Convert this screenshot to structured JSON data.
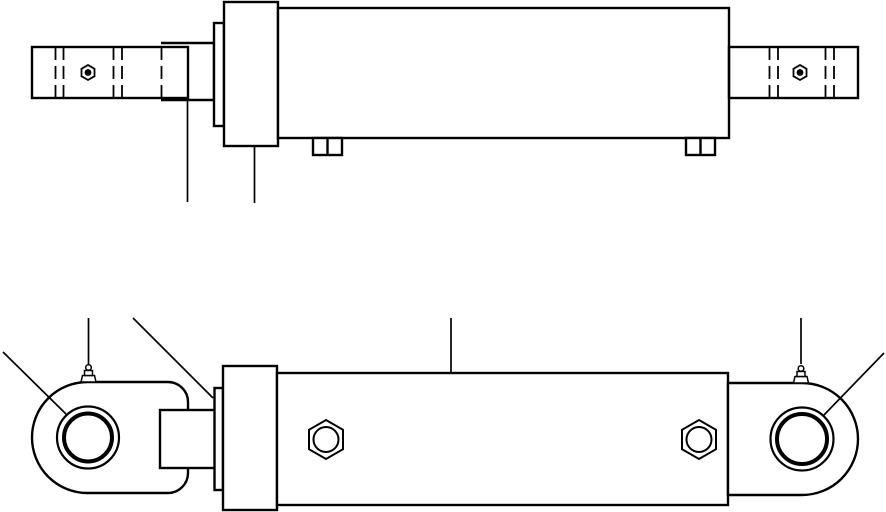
{
  "drawing": {
    "width": 886,
    "height": 512,
    "background": "#ffffff",
    "line_color": "#000000",
    "views": [
      {
        "name": "top-view",
        "shapes": [
          {
            "name": "piston-rod-block",
            "type": "path",
            "d": "M 161 43 L 214 43 L 214 100 L 161 100",
            "fill": "white",
            "sw": 2.4
          },
          {
            "name": "gland-flange",
            "type": "rect",
            "x": 214,
            "y": 23,
            "w": 10,
            "h": 103,
            "fill": "white",
            "sw": 2.4
          },
          {
            "name": "head-cap",
            "type": "rect",
            "x": 224,
            "y": 2,
            "w": 54,
            "h": 144,
            "fill": "white",
            "sw": 2.4
          },
          {
            "name": "cylinder-barrel",
            "type": "rect",
            "x": 278,
            "y": 8,
            "w": 451,
            "h": 130,
            "fill": "white",
            "sw": 2.4
          },
          {
            "name": "port-boss-left",
            "type": "rect",
            "x": 313,
            "y": 138,
            "w": 29,
            "h": 17,
            "fill": "white",
            "sw": 2.4
          },
          {
            "name": "port-boss-left-divider",
            "type": "line",
            "x1": 327.5,
            "y1": 138,
            "x2": 327.5,
            "y2": 155,
            "sw": 2.4
          },
          {
            "name": "port-boss-right",
            "type": "rect",
            "x": 686,
            "y": 138,
            "w": 29,
            "h": 17,
            "fill": "white",
            "sw": 2.4
          },
          {
            "name": "port-boss-right-divider",
            "type": "line",
            "x1": 700.5,
            "y1": 138,
            "x2": 700.5,
            "y2": 155,
            "sw": 2.4
          },
          {
            "name": "rod-eye-plate",
            "type": "rect",
            "x": 32,
            "y": 47,
            "w": 156,
            "h": 51,
            "fill": "none",
            "sw": 2.4
          },
          {
            "name": "rod-eye-groove-line-1",
            "type": "line",
            "x1": 55.5,
            "y1": 47,
            "x2": 55.5,
            "y2": 98,
            "sw": 1.8,
            "dash": "13 6"
          },
          {
            "name": "rod-eye-groove-line-2",
            "type": "line",
            "x1": 63.5,
            "y1": 47,
            "x2": 63.5,
            "y2": 98,
            "sw": 1.8,
            "dash": "13 6"
          },
          {
            "name": "rod-eye-groove-line-3",
            "type": "line",
            "x1": 113.5,
            "y1": 47,
            "x2": 113.5,
            "y2": 98,
            "sw": 1.8,
            "dash": "13 6"
          },
          {
            "name": "rod-eye-groove-line-4",
            "type": "line",
            "x1": 122,
            "y1": 47,
            "x2": 122,
            "y2": 98,
            "sw": 1.8,
            "dash": "13 6"
          },
          {
            "name": "rod-hidden-edge",
            "type": "line",
            "x1": 161.5,
            "y1": 47,
            "x2": 161.5,
            "y2": 98,
            "sw": 1.8,
            "dash": "13 6"
          },
          {
            "name": "rod-eye-pin-nut",
            "type": "polygon",
            "points": "88,65 94.5,68.8 94.5,76.2 88,80 81.5,76.2 81.5,68.8",
            "fill": "none",
            "sw": 1.8
          },
          {
            "name": "rod-eye-pin-nut-center",
            "type": "circle",
            "cx": 88,
            "cy": 72.5,
            "r": 3.4,
            "fill": "black",
            "sw": 0
          },
          {
            "name": "cap-eye-plate",
            "type": "rect",
            "x": 729,
            "y": 47,
            "w": 129,
            "h": 51,
            "fill": "none",
            "sw": 2.4
          },
          {
            "name": "cap-eye-groove-line-1",
            "type": "line",
            "x1": 769.5,
            "y1": 47,
            "x2": 769.5,
            "y2": 98,
            "sw": 1.8,
            "dash": "13 6"
          },
          {
            "name": "cap-eye-groove-line-2",
            "type": "line",
            "x1": 778,
            "y1": 47,
            "x2": 778,
            "y2": 98,
            "sw": 1.8,
            "dash": "13 6"
          },
          {
            "name": "cap-eye-groove-line-3",
            "type": "line",
            "x1": 825.5,
            "y1": 47,
            "x2": 825.5,
            "y2": 98,
            "sw": 1.8,
            "dash": "13 6"
          },
          {
            "name": "cap-eye-groove-line-4",
            "type": "line",
            "x1": 834,
            "y1": 47,
            "x2": 834,
            "y2": 98,
            "sw": 1.8,
            "dash": "13 6"
          },
          {
            "name": "cap-eye-pin-nut",
            "type": "polygon",
            "points": "800,65 806.5,68.8 806.5,76.2 800,80 793.5,76.2 793.5,68.8",
            "fill": "none",
            "sw": 1.8
          },
          {
            "name": "cap-eye-pin-nut-center",
            "type": "circle",
            "cx": 800,
            "cy": 72.5,
            "r": 3.4,
            "fill": "black",
            "sw": 0
          },
          {
            "name": "rod-leader-line",
            "type": "line",
            "x1": 187.5,
            "y1": 100,
            "x2": 187.5,
            "y2": 202,
            "sw": 1.7
          },
          {
            "name": "gland-leader-line",
            "type": "line",
            "x1": 254.5,
            "y1": 146,
            "x2": 254.5,
            "y2": 203,
            "sw": 1.7
          }
        ]
      },
      {
        "name": "side-view",
        "shapes": [
          {
            "name": "rod-eye-housing",
            "type": "roundrect",
            "x": 32,
            "y": 382,
            "w": 156,
            "h": 111,
            "radii": [
              55.5,
              20,
              20,
              55.5
            ],
            "fill": "white",
            "sw": 2.4
          },
          {
            "name": "rod-eye-bushing-outer",
            "type": "circle",
            "cx": 88,
            "cy": 437.5,
            "r": 31,
            "fill": "none",
            "sw": 2.2
          },
          {
            "name": "rod-eye-bushing-inner",
            "type": "circle",
            "cx": 88,
            "cy": 437.5,
            "r": 24,
            "fill": "none",
            "sw": 4
          },
          {
            "name": "rod-grease-zerk-base",
            "type": "polygon",
            "points": "81,382 82.5,375.5 94.5,375.5 96,382",
            "fill": "white",
            "sw": 1.5
          },
          {
            "name": "rod-grease-zerk-neck",
            "type": "rect",
            "x": 84.5,
            "y": 370.5,
            "w": 8,
            "h": 5,
            "fill": "white",
            "sw": 1.5
          },
          {
            "name": "rod-grease-zerk-ball",
            "type": "circle",
            "cx": 88.5,
            "cy": 367.5,
            "r": 2.8,
            "fill": "white",
            "sw": 1.5
          },
          {
            "name": "piston-rod-side",
            "type": "rect",
            "x": 160,
            "y": 410,
            "w": 55,
            "h": 58,
            "fill": "white",
            "sw": 2.4
          },
          {
            "name": "gland-flange-side",
            "type": "rect",
            "x": 214.5,
            "y": 388,
            "w": 8.5,
            "h": 102,
            "fill": "white",
            "sw": 2.4
          },
          {
            "name": "head-cap-side",
            "type": "rect",
            "x": 223,
            "y": 366,
            "w": 54,
            "h": 144,
            "fill": "white",
            "sw": 2.4
          },
          {
            "name": "cylinder-barrel-side",
            "type": "rect",
            "x": 277,
            "y": 373,
            "w": 451,
            "h": 132,
            "fill": "white",
            "sw": 2.4
          },
          {
            "name": "hex-plug-left",
            "type": "polygon",
            "points": "326,420 343,429.8 343,449.2 326,459 309,449.2 309,429.8",
            "fill": "white",
            "sw": 2
          },
          {
            "name": "hex-plug-left-bore",
            "type": "circle",
            "cx": 326,
            "cy": 439.5,
            "r": 12.5,
            "fill": "none",
            "sw": 2
          },
          {
            "name": "hex-plug-right",
            "type": "polygon",
            "points": "699,420 716,429.8 716,449.2 699,459 682,449.2 682,429.8",
            "fill": "white",
            "sw": 2
          },
          {
            "name": "hex-plug-right-bore",
            "type": "circle",
            "cx": 699,
            "cy": 439.5,
            "r": 12.5,
            "fill": "none",
            "sw": 2
          },
          {
            "name": "cap-eye-housing",
            "type": "roundrect",
            "x": 728,
            "y": 383,
            "w": 130,
            "h": 112,
            "radii": [
              0,
              56,
              56,
              0
            ],
            "fill": "white",
            "sw": 2.4
          },
          {
            "name": "cap-eye-bushing-outer",
            "type": "circle",
            "cx": 802,
            "cy": 439,
            "r": 31.5,
            "fill": "none",
            "sw": 2.2
          },
          {
            "name": "cap-eye-bushing-inner",
            "type": "circle",
            "cx": 802,
            "cy": 439,
            "r": 25,
            "fill": "none",
            "sw": 4
          },
          {
            "name": "cap-grease-zerk-base",
            "type": "polygon",
            "points": "793.5,383 795,376.5 807,376.5 808.5,383",
            "fill": "white",
            "sw": 1.5
          },
          {
            "name": "cap-grease-zerk-neck",
            "type": "rect",
            "x": 797,
            "y": 371.5,
            "w": 8,
            "h": 5,
            "fill": "white",
            "sw": 1.5
          },
          {
            "name": "cap-grease-zerk-ball",
            "type": "circle",
            "cx": 801,
            "cy": 368.5,
            "r": 2.8,
            "fill": "white",
            "sw": 1.5
          },
          {
            "name": "leader-rod-bushing",
            "type": "line",
            "x1": 3,
            "y1": 352,
            "x2": 66,
            "y2": 414,
            "sw": 1.7
          },
          {
            "name": "leader-rod-zerk",
            "type": "line",
            "x1": 88.5,
            "y1": 318,
            "x2": 88.5,
            "y2": 364,
            "sw": 1.7
          },
          {
            "name": "leader-gland-side",
            "type": "line",
            "x1": 133,
            "y1": 318,
            "x2": 213,
            "y2": 398,
            "sw": 1.7
          },
          {
            "name": "leader-barrel",
            "type": "line",
            "x1": 451,
            "y1": 318,
            "x2": 451,
            "y2": 373,
            "sw": 1.7
          },
          {
            "name": "leader-cap-zerk",
            "type": "line",
            "x1": 801,
            "y1": 318,
            "x2": 801,
            "y2": 364,
            "sw": 1.7
          },
          {
            "name": "leader-cap-bushing",
            "type": "line",
            "x1": 884,
            "y1": 353,
            "x2": 823,
            "y2": 416,
            "sw": 1.7
          }
        ]
      }
    ]
  }
}
